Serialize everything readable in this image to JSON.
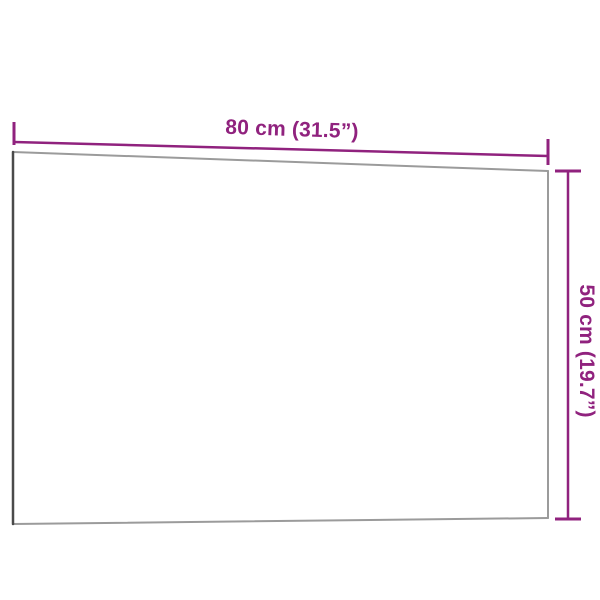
{
  "figure": {
    "description": "Product dimension diagram of a rectangular wall-mounted board shown in slight perspective on a white background"
  },
  "dimensions": {
    "width": {
      "label": "80 cm (31.5”)",
      "cm": 80,
      "inches": 31.5
    },
    "height": {
      "label": "50 cm (19.7”)",
      "cm": 50,
      "inches": 19.7
    }
  },
  "colors": {
    "dimension_accent": "#90227E",
    "board_edge_dark": "#4A4A4A",
    "board_edge_light": "#9B9B9B",
    "board_fill": "#FFFFFF",
    "background": "#FFFFFF"
  }
}
